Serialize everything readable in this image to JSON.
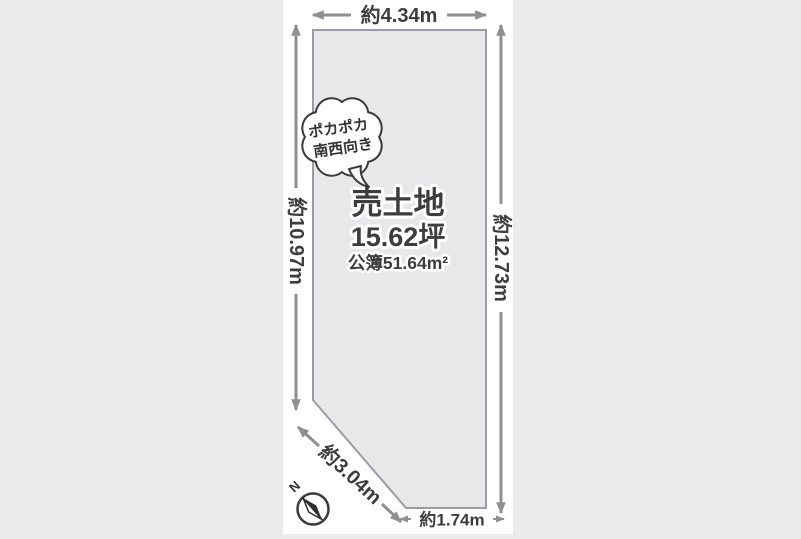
{
  "plot": {
    "title": "売土地",
    "area_tsubo": "15.62坪",
    "area_registered": "公簿51.64m²"
  },
  "dimensions": {
    "top": "約4.34m",
    "left": "約10.97m",
    "right": "約12.73m",
    "diagonal": "約3.04m",
    "bottom": "約1.74m"
  },
  "bubble": {
    "line1": "ポカポカ",
    "line2": "南西向き"
  },
  "compass": {
    "label": "N"
  },
  "colors": {
    "background": "#ebebeb",
    "panel": "#ffffff",
    "plot_fill": "#e8e8eb",
    "plot_border": "#9b9ba3",
    "arrow": "#8f8f8f",
    "text": "#3d3d3d"
  }
}
